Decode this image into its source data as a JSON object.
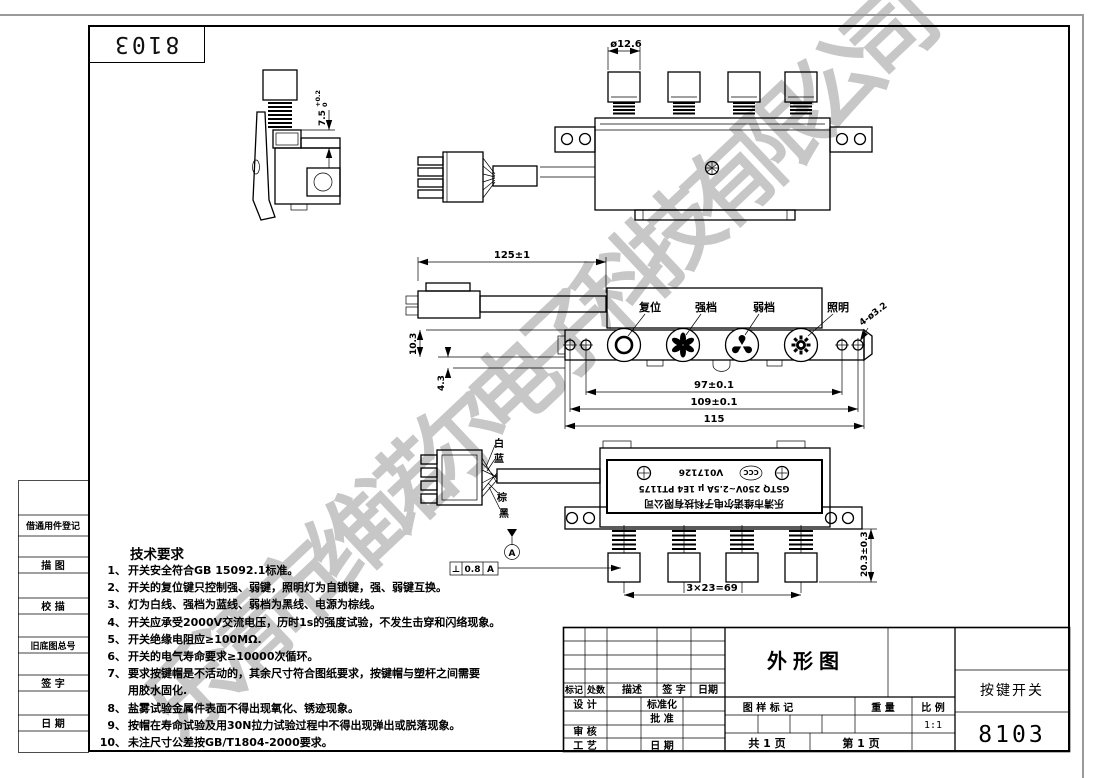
{
  "watermark": "乐清市维诺尔电子科技有限公司",
  "corner_code": "8103",
  "left_column": {
    "register": "借通用件登记",
    "trace": "描  图",
    "check_trace": "校  描",
    "old_no": "旧底图总号",
    "sign": "签  字",
    "date": "日  期"
  },
  "tech": {
    "title": "技术要求",
    "items": [
      {
        "n": "1、",
        "t": "开关安全符合GB 15092.1标准。"
      },
      {
        "n": "2、",
        "t": "开关的复位键只控制强、弱键，照明灯为自锁键，强、弱键互换。"
      },
      {
        "n": "3、",
        "t": "灯为白线、强档为蓝线、弱档为黑线、电源为棕线。"
      },
      {
        "n": "4、",
        "t": "开关应承受2000V交流电压，历时1s的强度试验，不发生击穿和闪络现象。"
      },
      {
        "n": "5、",
        "t": "开关绝缘电阻应≥100MΩ."
      },
      {
        "n": "6、",
        "t": "开关的电气寿命要求≥10000次循环。"
      },
      {
        "n": "7、",
        "t": "要求按键帽是不活动的，其余尺寸符合图纸要求，按键帽与塑杆之间需要"
      },
      {
        "n": "",
        "t": "用胶水固化."
      },
      {
        "n": "8、",
        "t": "盐雾试验金属件表面不得出现氧化、锈迹现象。"
      },
      {
        "n": "9、",
        "t": "按帽在寿命试验及用30N拉力试验过程中不得出现弹出或脱落现象。"
      },
      {
        "n": "10、",
        "t": "未注尺寸公差按GB/T1804-2000要求。"
      }
    ]
  },
  "views": {
    "side": {
      "dim_value": "7.5",
      "tol_plus": "+0.2",
      "tol_minus": "0"
    },
    "front": {
      "cap_dia": "ø12.6"
    },
    "top": {
      "cable_len": "125±1",
      "h1": "10.3",
      "h2": "4.3",
      "w_inner": "97±0.1",
      "w_outer": "109±0.1",
      "w_total": "115",
      "holes": "4-ø3.2",
      "btn_reset": "复位",
      "btn_high": "强档",
      "btn_low": "弱档",
      "btn_light": "照明"
    },
    "bottom": {
      "wire_white": "白",
      "wire_blue": "蓝",
      "wire_brown": "棕",
      "wire_black": "黑",
      "pitch": "3×23=69",
      "height": "20.3±0.3",
      "gtol_sym": "⊥",
      "gtol_val": "0.8",
      "gtol_datum": "A",
      "datum": "A",
      "label": {
        "company": "乐清市维诺尔电子科技有限公司",
        "rating": "GSTQ  250V~2.5A  μ  1E4  PT1175",
        "cert": "CCC",
        "cert_no": "V017126"
      }
    }
  },
  "title_block": {
    "rev": {
      "mark": "标记",
      "count": "处数",
      "desc": "描述",
      "sign": "签  字",
      "date": "日期"
    },
    "design": "设  计",
    "standardize": "标准化",
    "approve": "批  准",
    "audit": "审  核",
    "process": "工  艺",
    "date": "日  期",
    "view_name": "外形图",
    "mark_label": "图 样 标 记",
    "weight_label": "重  量",
    "scale_label": "比  例",
    "scale": "1:1",
    "total_pages": "共 1 页",
    "page": "第 1 页",
    "product": "按键开关",
    "code": "8103"
  }
}
